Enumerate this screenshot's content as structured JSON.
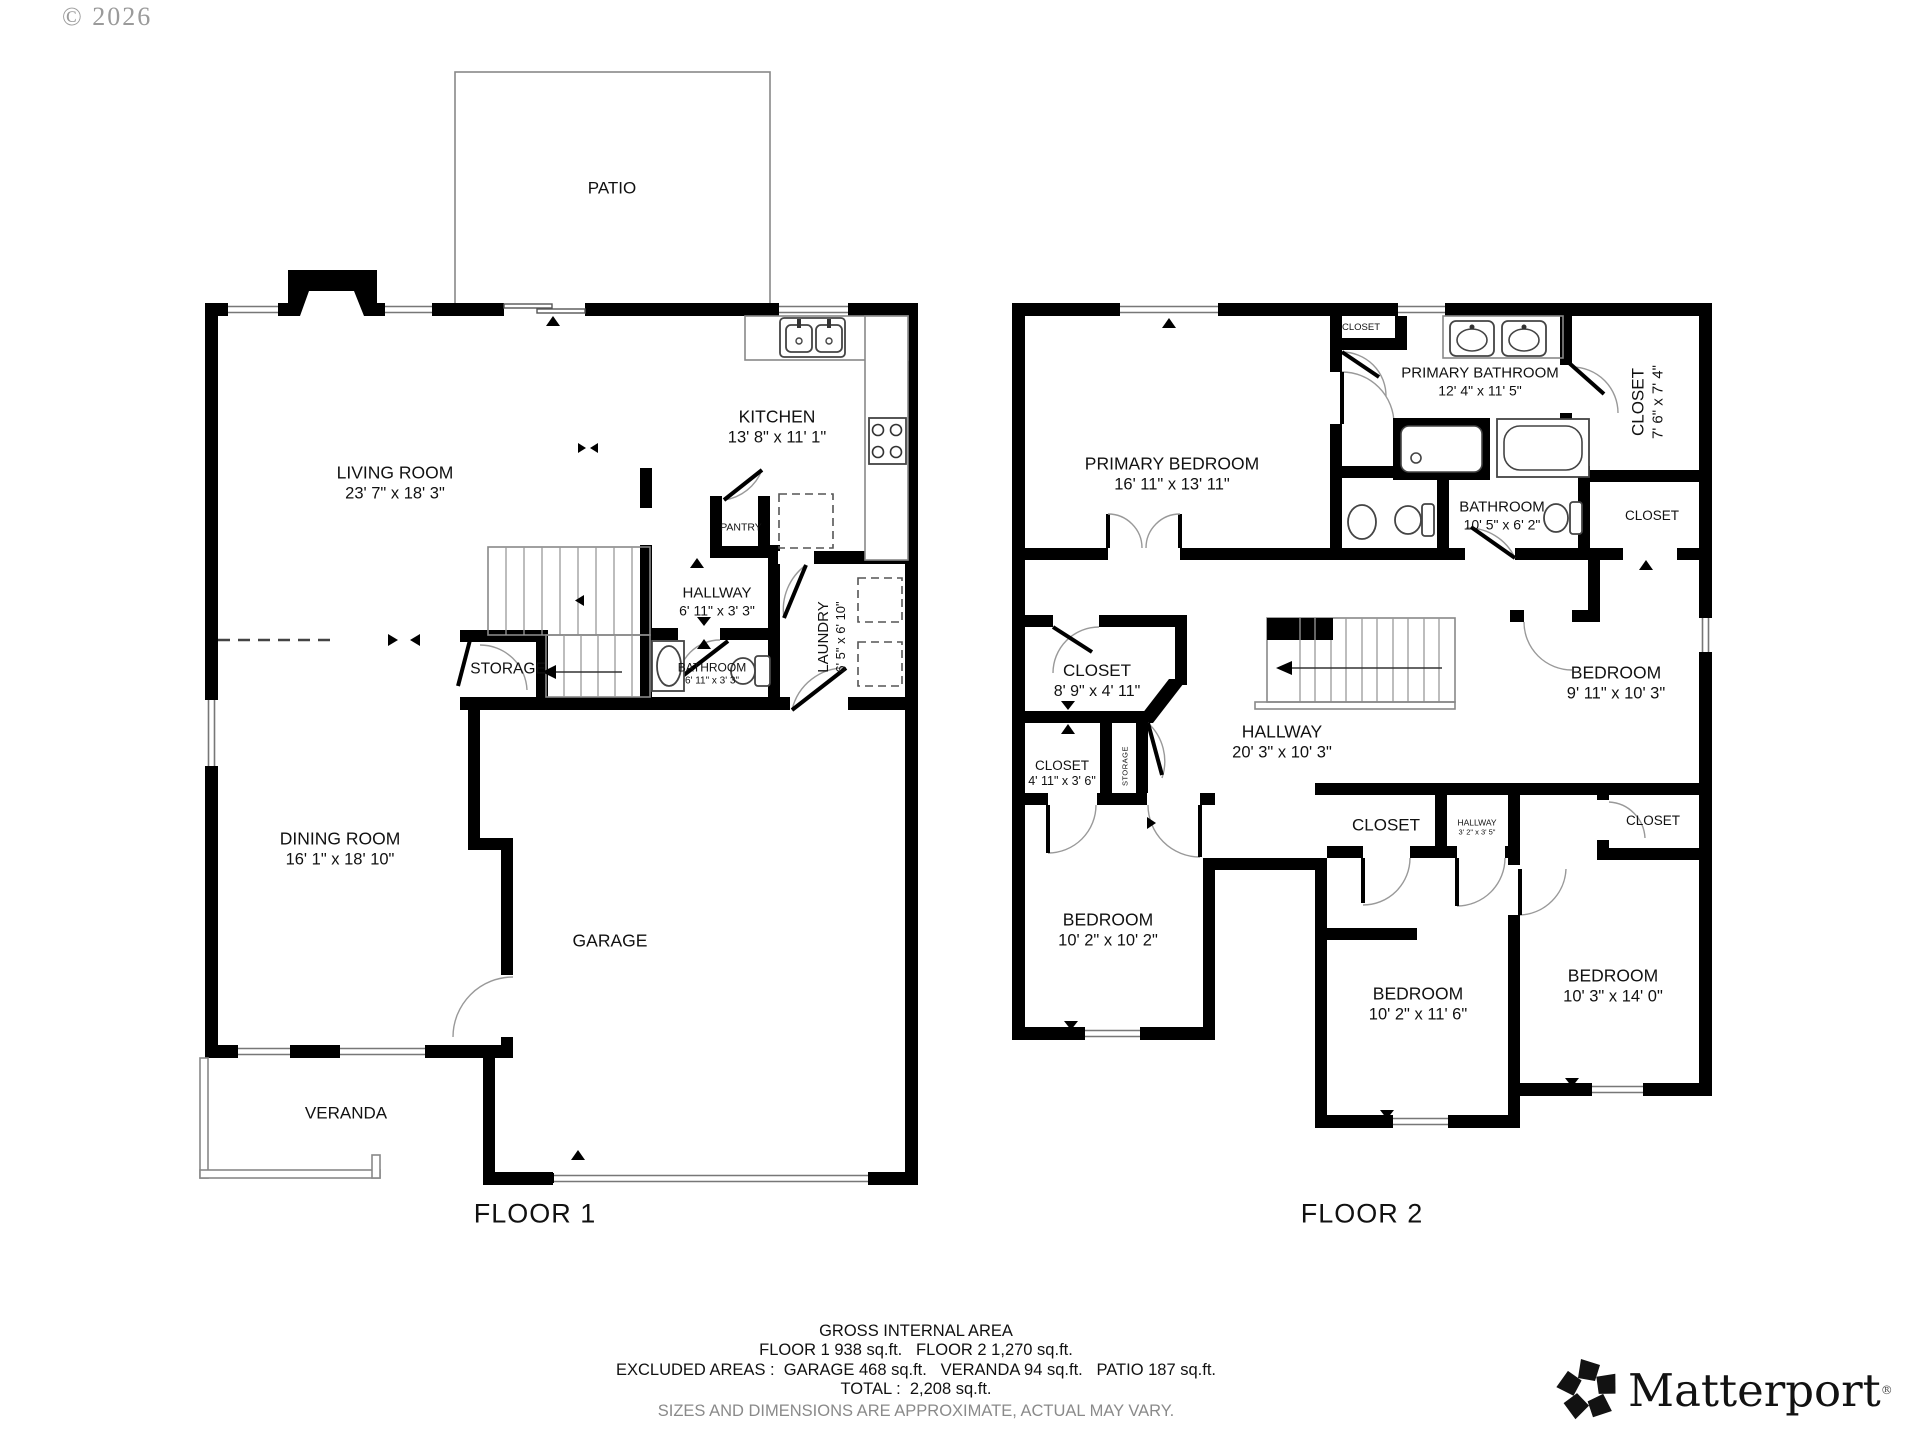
{
  "copyright": "© 2026",
  "floor1": {
    "title": "FLOOR 1",
    "rooms": {
      "patio": {
        "name": "PATIO"
      },
      "living": {
        "name": "LIVING ROOM",
        "dims": "23' 7\" x 18' 3\""
      },
      "kitchen": {
        "name": "KITCHEN",
        "dims": "13' 8\" x 11' 1\""
      },
      "pantry": {
        "name": "PANTRY"
      },
      "hallway": {
        "name": "HALLWAY",
        "dims": "6' 11\" x 3' 3\""
      },
      "storage": {
        "name": "STORAGE"
      },
      "bathroom": {
        "name": "BATHROOM",
        "dims": "6' 11\" x 3' 3\""
      },
      "laundry": {
        "name": "LAUNDRY",
        "dims": "6' 5\" x 6' 10\""
      },
      "dining": {
        "name": "DINING ROOM",
        "dims": "16' 1\" x 18' 10\""
      },
      "garage": {
        "name": "GARAGE"
      },
      "veranda": {
        "name": "VERANDA"
      }
    }
  },
  "floor2": {
    "title": "FLOOR 2",
    "rooms": {
      "primary_bedroom": {
        "name": "PRIMARY BEDROOM",
        "dims": "16' 11\" x 13' 11\""
      },
      "closet_top": {
        "name": "CLOSET"
      },
      "primary_bathroom": {
        "name": "PRIMARY BATHROOM",
        "dims": "12' 4\" x 11' 5\""
      },
      "walkin_closet": {
        "name": "CLOSET",
        "dims": "7' 6\" x 7' 4\""
      },
      "bathroom": {
        "name": "BATHROOM",
        "dims": "10' 5\" x 6' 2\""
      },
      "closet_mid_right": {
        "name": "CLOSET"
      },
      "closet_89": {
        "name": "CLOSET",
        "dims": "8' 9\" x 4' 11\""
      },
      "hallway": {
        "name": "HALLWAY",
        "dims": "20' 3\" x 10' 3\""
      },
      "closet_411": {
        "name": "CLOSET",
        "dims": "4' 11\" x 3' 6\""
      },
      "storage": {
        "name": "STORAGE"
      },
      "closet_bottom_mid": {
        "name": "CLOSET"
      },
      "hallway_small": {
        "name": "HALLWAY",
        "dims": "3' 2\" x 3' 5\""
      },
      "bedroom_ne": {
        "name": "BEDROOM",
        "dims": "9' 11\" x 10' 3\""
      },
      "closet_se": {
        "name": "CLOSET"
      },
      "bedroom_sw": {
        "name": "BEDROOM",
        "dims": "10' 2\" x 10' 2\""
      },
      "bedroom_s": {
        "name": "BEDROOM",
        "dims": "10' 2\" x 11' 6\""
      },
      "bedroom_se": {
        "name": "BEDROOM",
        "dims": "10' 3\" x 14' 0\""
      }
    }
  },
  "footer": {
    "line1": "GROSS INTERNAL AREA",
    "line2": "FLOOR 1 938 sq.ft.   FLOOR 2 1,270 sq.ft.",
    "line3": "EXCLUDED AREAS :  GARAGE 468 sq.ft.   VERANDA 94 sq.ft.   PATIO 187 sq.ft.",
    "line4": "TOTAL :  2,208 sq.ft.",
    "line5": "SIZES AND DIMENSIONS ARE APPROXIMATE, ACTUAL MAY VARY."
  },
  "logo": {
    "text": "Matterport",
    "mark": "®"
  }
}
